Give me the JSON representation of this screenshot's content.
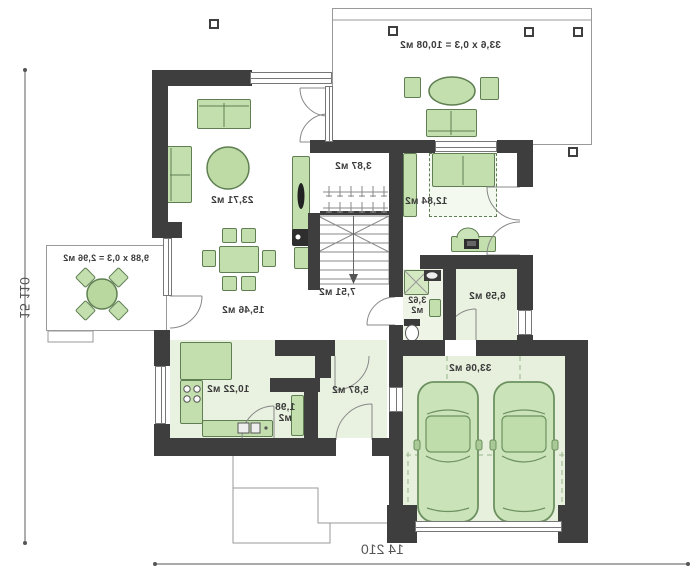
{
  "plan": {
    "dimensions": {
      "left": "15 110",
      "bottom": "14 210"
    },
    "terraces": {
      "top_label": "33,6 x 0,3 = 10,08 м2",
      "left_label": "9,88 x 0,3 = 2,96 м2"
    },
    "rooms": {
      "living": "23,71 м2",
      "dining": "15,46 м2",
      "kitchen": "10,22 м2",
      "pantry_l1": "1,98",
      "pantry_l2": "м2",
      "entry": "5,87 м2",
      "hall": "7,51 м2",
      "wardrobe": "3,87 м2",
      "bedroom": "12,84 м2",
      "bath_l1": "3,62",
      "bath_l2": "м2",
      "utility": "6,59 м2",
      "garage": "33,06 м2"
    },
    "colors": {
      "wall": "#3e3e3e",
      "furniture": "#c3dfae",
      "furniture_border": "#5f7f52",
      "floor_tint": "#e9f2e0",
      "garage_floor": "#e6f0dc",
      "label_text": "#3a3a3a"
    }
  }
}
